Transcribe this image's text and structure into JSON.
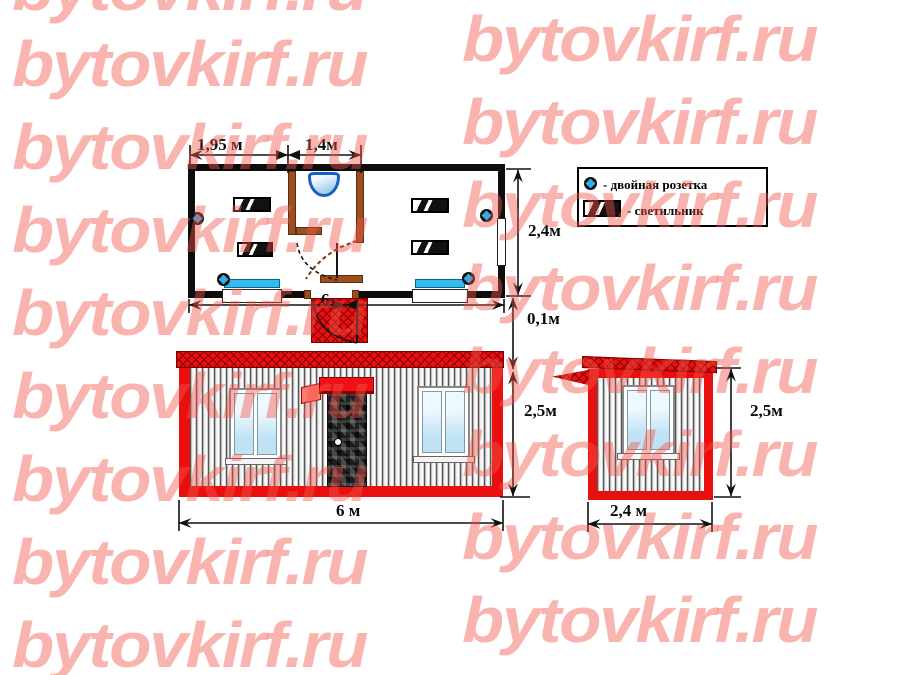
{
  "watermark": {
    "text": "bytovkirf.ru"
  },
  "colors": {
    "accent_red": "#e90f0f",
    "watermark_red": "#f25548",
    "socket_blue": "#2fb0e8"
  },
  "plan": {
    "dim_room_left": "1,95 м",
    "dim_room_mid": "1,4м",
    "dim_depth": "2,4м",
    "dim_offset": "0,1м",
    "dim_total": "6"
  },
  "legend": {
    "socket_label": "- двойная розетка",
    "light_label": "- светильник"
  },
  "front": {
    "dim_width": "6 м",
    "dim_height": "2,5м"
  },
  "side": {
    "dim_width": "2,4 м",
    "dim_height": "2,5м"
  }
}
